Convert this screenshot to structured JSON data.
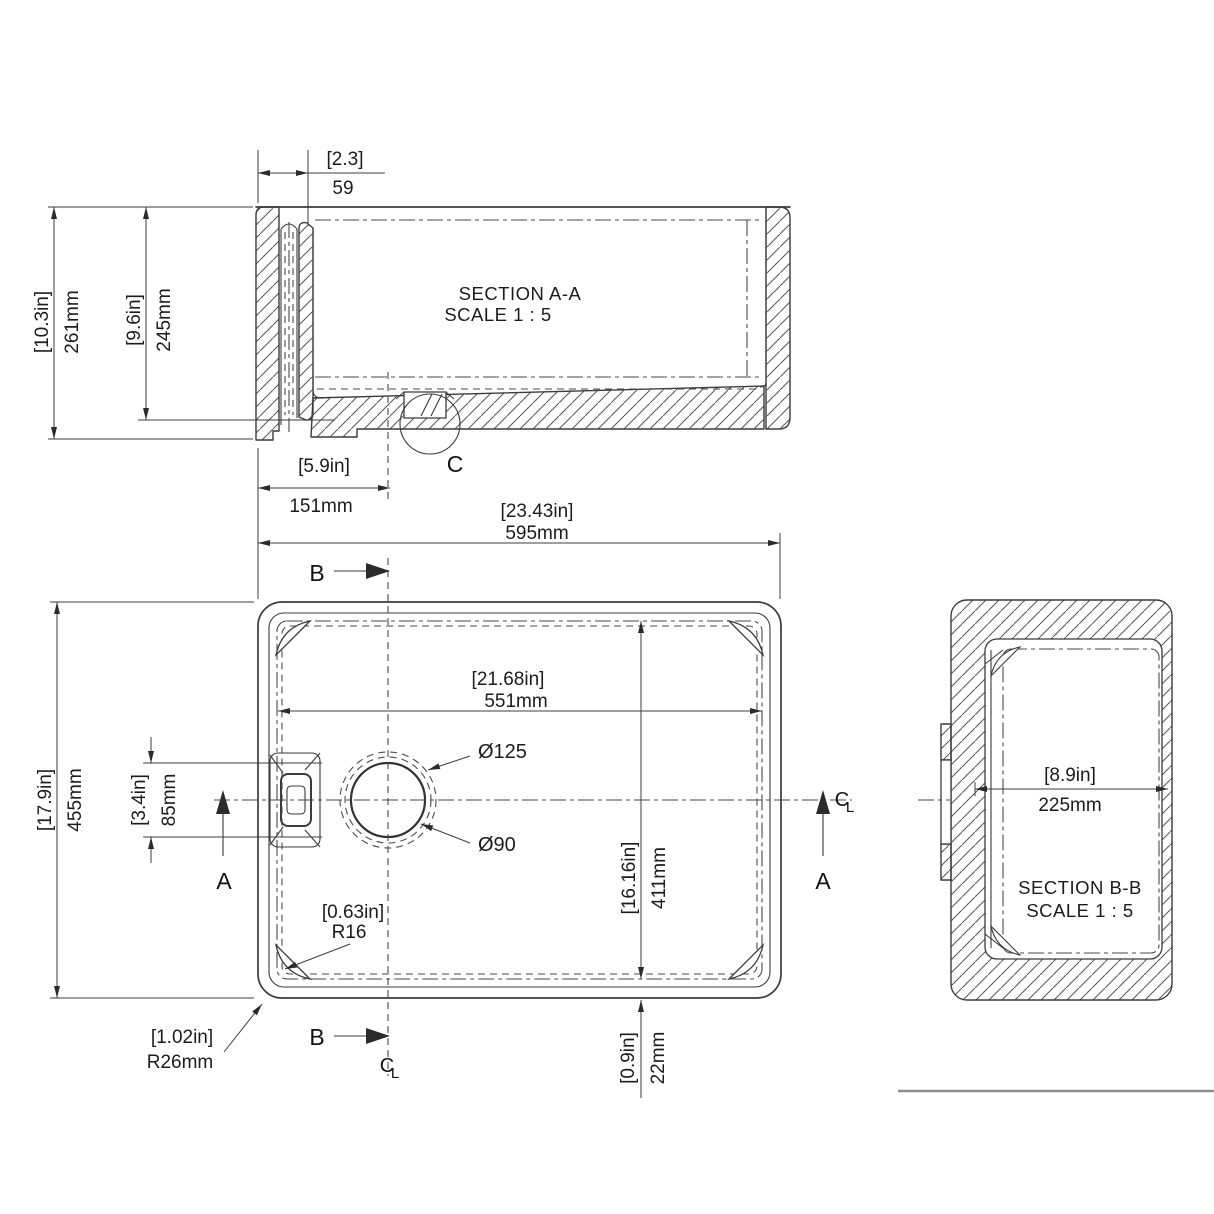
{
  "labels": {
    "section_aa_title": "SECTION A-A",
    "section_aa_scale": "SCALE 1 : 5",
    "section_bb_title": "SECTION B-B",
    "section_bb_scale": "SCALE 1 : 5",
    "detail_c": "C",
    "arrow_a_left": "A",
    "arrow_a_right": "A",
    "arrow_b_top": "B",
    "arrow_b_bottom": "B",
    "centerline_c": "C",
    "centerline_l": "L"
  },
  "dimensions": {
    "apron_thickness": {
      "inches": "[2.3]",
      "mm": "59"
    },
    "overall_height": {
      "inches": "[10.3in]",
      "mm": "261mm"
    },
    "bowl_depth": {
      "inches": "[9.6in]",
      "mm": "245mm"
    },
    "drain_offset": {
      "inches": "[5.9in]",
      "mm": "151mm"
    },
    "overall_length": {
      "inches": "[23.43in]",
      "mm": "595mm"
    },
    "bowl_length": {
      "inches": "[21.68in]",
      "mm": "551mm"
    },
    "overall_width": {
      "inches": "[17.9in]",
      "mm": "455mm"
    },
    "overflow_width": {
      "inches": "[3.4in]",
      "mm": "85mm"
    },
    "bowl_width": {
      "inches": "[16.16in]",
      "mm": "411mm"
    },
    "wall_offset": {
      "inches": "[0.9in]",
      "mm": "22mm"
    },
    "inner_corner_radius": {
      "inches": "[0.63in]",
      "mm": "R16"
    },
    "outer_corner_radius": {
      "inches": "[1.02in]",
      "mm": "R26mm"
    },
    "section_bb_width": {
      "inches": "[8.9in]",
      "mm": "225mm"
    },
    "drain_outer_dia": "Ø125",
    "drain_inner_dia": "Ø90"
  }
}
